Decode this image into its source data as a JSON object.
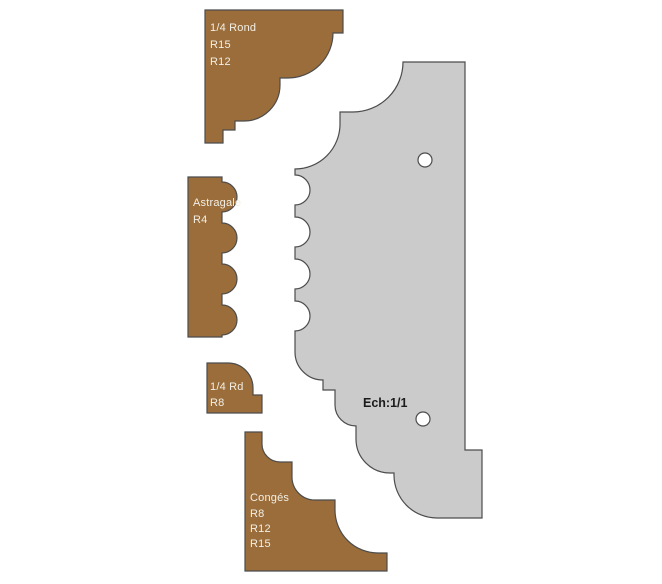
{
  "drawing": {
    "profiles": [
      {
        "id": "quarter-rond",
        "lines": [
          "1/4 Rond",
          "R15",
          "R12"
        ]
      },
      {
        "id": "astragale",
        "lines": [
          "Astragale",
          "R4"
        ]
      },
      {
        "id": "quarter-rd",
        "lines": [
          "1/4 Rd",
          "R8"
        ]
      },
      {
        "id": "conges",
        "lines": [
          "Congés",
          "R8",
          "R12",
          "R15"
        ]
      }
    ],
    "knife": {
      "scale_label": "Ech:1/1",
      "hole_count": 2
    },
    "colors": {
      "wood": "#9a6d3a",
      "knife_steel": "#cbcbcb",
      "outline": "#4c4c4c",
      "label_text": "#f3efe6",
      "scale_text": "#1b1b1b",
      "hole": "#ffffff",
      "background": "#ffffff"
    }
  }
}
